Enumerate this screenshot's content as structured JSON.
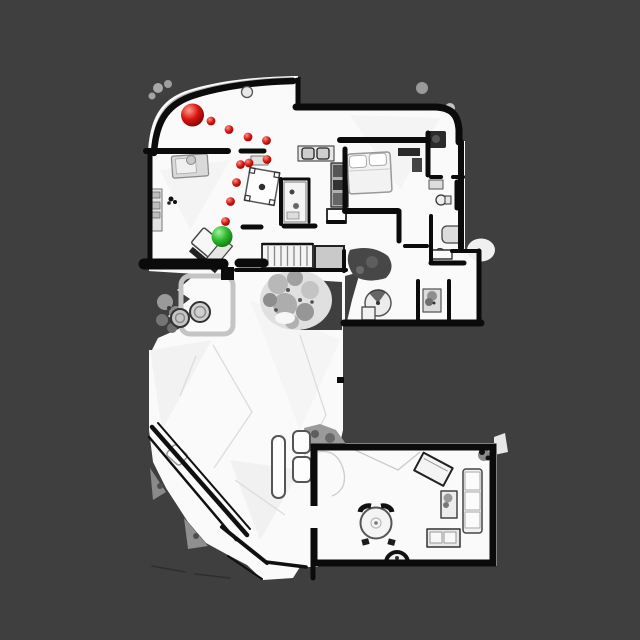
{
  "viewport": {
    "width": 640,
    "height": 640,
    "background_color": "#3f3f3f"
  },
  "floorplan": {
    "floor_color": "#fafafa",
    "wall_color": "#0b0b0b",
    "balcony_color": "#b3b3b3",
    "terrace_rock_color": "#9a9a9a",
    "landing_color": "#c9c9c9",
    "plant_color": "#a8a8a8"
  },
  "markers": {
    "start": {
      "label": "start-position-sphere",
      "x": 192.5,
      "y": 115,
      "r": 11.5,
      "highlight": "#ff9d8a",
      "base": "#da1510",
      "edge": "#6e0303"
    },
    "goal": {
      "label": "goal-position-sphere",
      "x": 222,
      "y": 236.5,
      "r": 10.5,
      "highlight": "#a0f2a0",
      "base": "#2eb82e",
      "edge": "#0b6e0b"
    },
    "trail": {
      "label": "path-waypoint-dots",
      "dot_radius": 4.4,
      "highlight": "#ff8f7d",
      "base": "#cf1310",
      "edge": "#7c0505",
      "points": [
        [
          211,
          121
        ],
        [
          229,
          129.5
        ],
        [
          248,
          137
        ],
        [
          266.5,
          140.5
        ],
        [
          267,
          159.5
        ],
        [
          249,
          163
        ],
        [
          240.5,
          164.5
        ],
        [
          236.5,
          182.5
        ],
        [
          230.5,
          201.5
        ],
        [
          225.5,
          221.5
        ]
      ]
    }
  }
}
